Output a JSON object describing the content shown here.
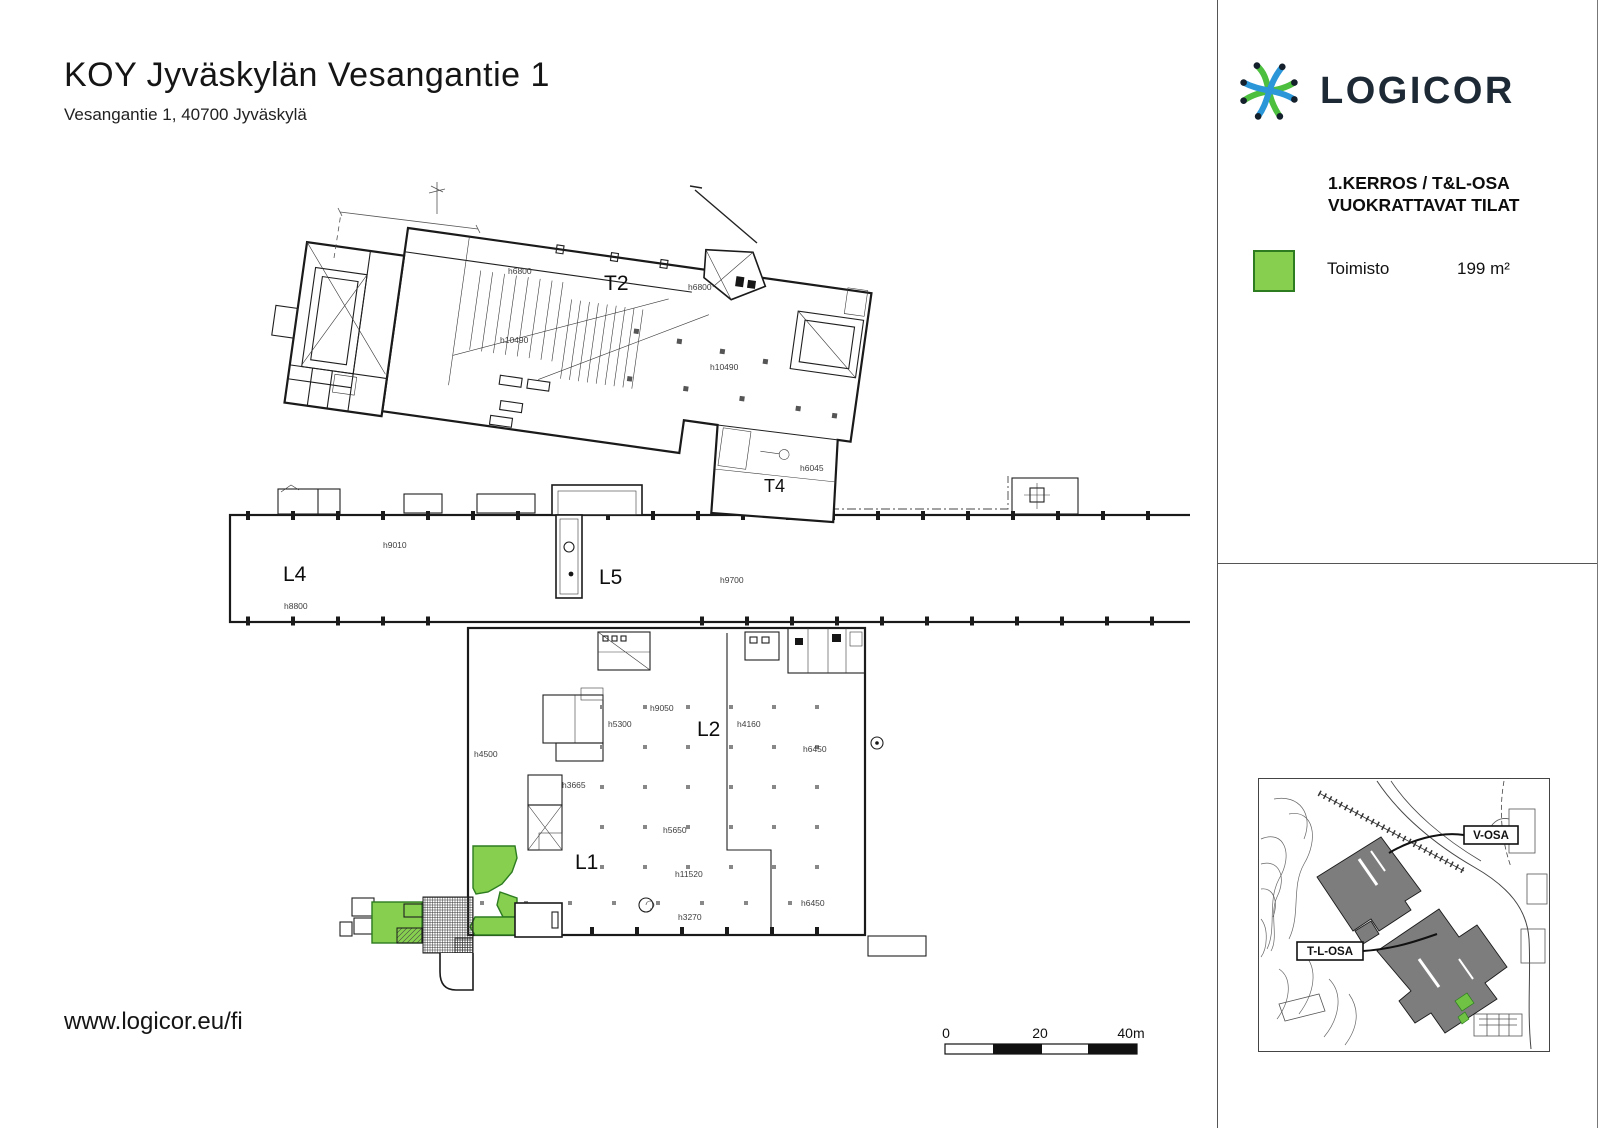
{
  "header": {
    "title": "KOY Jyväskylän Vesangantie 1",
    "subtitle": "Vesangantie 1, 40700 Jyväskylä"
  },
  "footer": {
    "website": "www.logicor.eu/fi"
  },
  "sidebar": {
    "brand": "LOGICOR",
    "heading_line1": "1.KERROS / T&L-OSA",
    "heading_line2": "VUOKRATTAVAT TILAT",
    "legend": [
      {
        "label": "Toimisto",
        "area": "199 m²",
        "color": "#86cf4f"
      }
    ],
    "site_map": {
      "labels": [
        {
          "text": "V-OSA"
        },
        {
          "text": "T-L-OSA"
        }
      ]
    }
  },
  "plan": {
    "zone_labels": [
      {
        "text": "T2",
        "x": 604,
        "y": 290,
        "size": 21
      },
      {
        "text": "T4",
        "x": 764,
        "y": 492,
        "size": 18
      },
      {
        "text": "L4",
        "x": 283,
        "y": 581,
        "size": 21
      },
      {
        "text": "L5",
        "x": 599,
        "y": 584,
        "size": 21
      },
      {
        "text": "L2",
        "x": 697,
        "y": 736,
        "size": 21
      },
      {
        "text": "L1",
        "x": 575,
        "y": 869,
        "size": 21
      }
    ],
    "height_labels": [
      {
        "text": "h6800",
        "x": 508,
        "y": 274
      },
      {
        "text": "h6800",
        "x": 688,
        "y": 290
      },
      {
        "text": "h10490",
        "x": 500,
        "y": 343
      },
      {
        "text": "h10490",
        "x": 710,
        "y": 370
      },
      {
        "text": "h6045",
        "x": 800,
        "y": 471
      },
      {
        "text": "h9010",
        "x": 383,
        "y": 548
      },
      {
        "text": "h8800",
        "x": 284,
        "y": 609
      },
      {
        "text": "h9700",
        "x": 720,
        "y": 583
      },
      {
        "text": "h4500",
        "x": 474,
        "y": 757
      },
      {
        "text": "h5300",
        "x": 608,
        "y": 727
      },
      {
        "text": "h9050",
        "x": 650,
        "y": 711
      },
      {
        "text": "h4160",
        "x": 737,
        "y": 727
      },
      {
        "text": "h6450",
        "x": 803,
        "y": 752
      },
      {
        "text": "h3665",
        "x": 562,
        "y": 788
      },
      {
        "text": "h5650",
        "x": 663,
        "y": 833
      },
      {
        "text": "h11520",
        "x": 675,
        "y": 877
      },
      {
        "text": "h6450",
        "x": 801,
        "y": 906
      },
      {
        "text": "h3270",
        "x": 678,
        "y": 920
      }
    ],
    "scale_bar": {
      "ticks": [
        {
          "label": "0",
          "x": 946
        },
        {
          "label": "20",
          "x": 1040
        },
        {
          "label": "40m",
          "x": 1131
        }
      ]
    }
  },
  "colors": {
    "accent_green": "#86cf4f",
    "green_border": "#2d7c20",
    "brand_navy": "#1d2a36",
    "logo_green": "#4cbf3f",
    "logo_blue": "#2b96d8",
    "map_building_gray": "#7d7d7d"
  }
}
